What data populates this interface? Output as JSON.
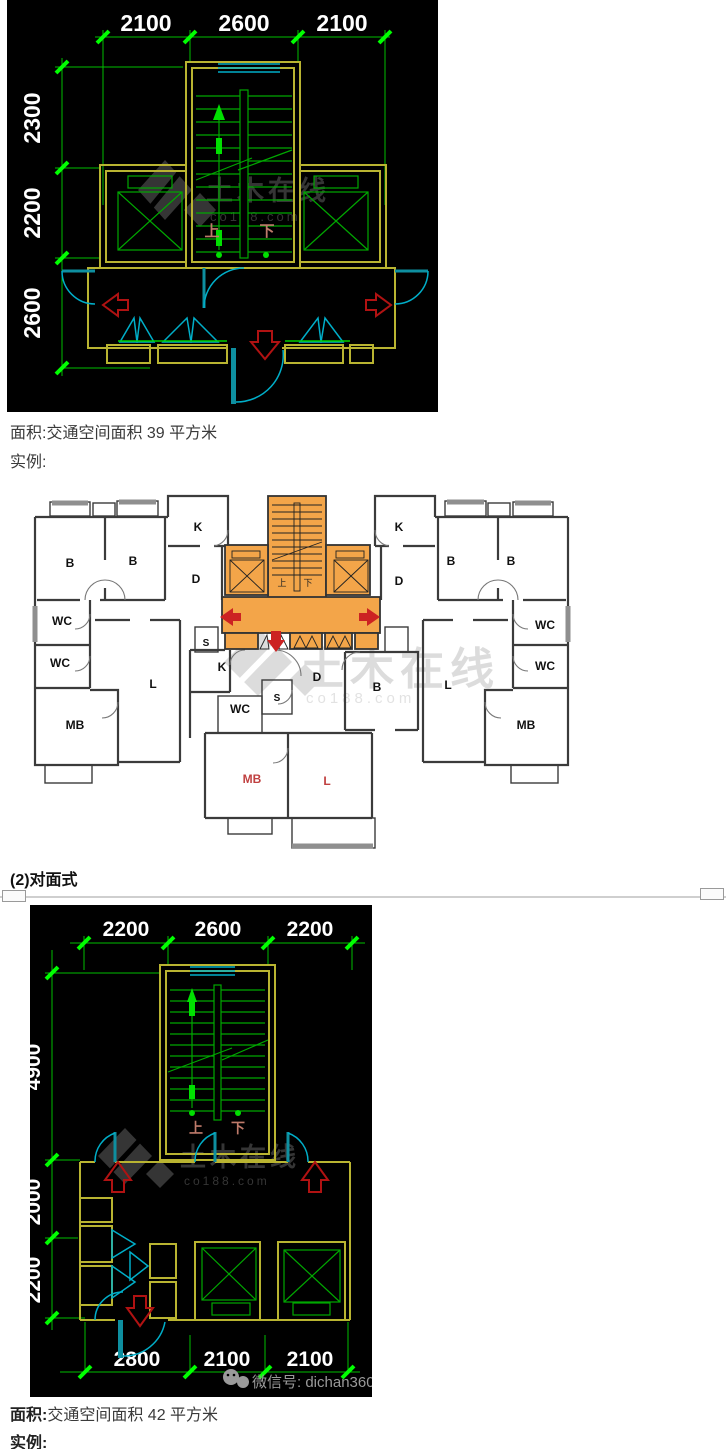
{
  "colors": {
    "canvas_bg": "#000000",
    "dim_line_green": "#00be00",
    "dim_tick_green": "#00ff00",
    "dim_text": "#ffffff",
    "wall_yellow": "#b9b431",
    "fixture_green": "#00a800",
    "door_cyan": "#00aec8",
    "arrow_red": "#b01212",
    "core_orange": "#f3a549",
    "plan_wall": "#3b3b3b",
    "plan_arrow_red": "#cc2222",
    "stair_text": "#be7a6a",
    "watermark_dark": "#3a3a3a",
    "watermark_light": "#d4d4d4",
    "wechat_gray": "#9a9a9a"
  },
  "captions": {
    "area1_label": "面积:",
    "area1_text": "交通空间面积 39 平方米",
    "example1": "实例:",
    "section_heading": "(2)对面式",
    "area2_label": "面积:",
    "area2_text": "交通空间面积 42 平方米",
    "example2": "实例:"
  },
  "drawing1": {
    "dims_top": [
      "2100",
      "2600",
      "2100"
    ],
    "dims_left": [
      "2300",
      "2200",
      "2600"
    ],
    "stair_up": "上",
    "stair_down": "下",
    "watermark_title": "土木在线",
    "watermark_sub": "co188.com"
  },
  "plan": {
    "rooms": [
      "B",
      "B",
      "K",
      "D",
      "WC",
      "WC",
      "MB",
      "L",
      "S",
      "K",
      "B",
      "B",
      "D",
      "WC",
      "WC",
      "MB",
      "L",
      "B",
      "K",
      "S",
      "WC",
      "D"
    ],
    "rooms_red": [
      "MB",
      "L"
    ],
    "stair_up": "上",
    "stair_down": "下",
    "watermark_title": "土木在线",
    "watermark_sub": "co188.com"
  },
  "drawing2": {
    "dims_top": [
      "2200",
      "2600",
      "2200"
    ],
    "dims_left": [
      "4900",
      "2000",
      "2200"
    ],
    "dims_bottom": [
      "2800",
      "2100",
      "2100"
    ],
    "stair_up": "上",
    "stair_down": "下",
    "watermark_title": "土木在线",
    "watermark_sub": "co188.com",
    "wechat_text": "微信号: dichan360"
  }
}
